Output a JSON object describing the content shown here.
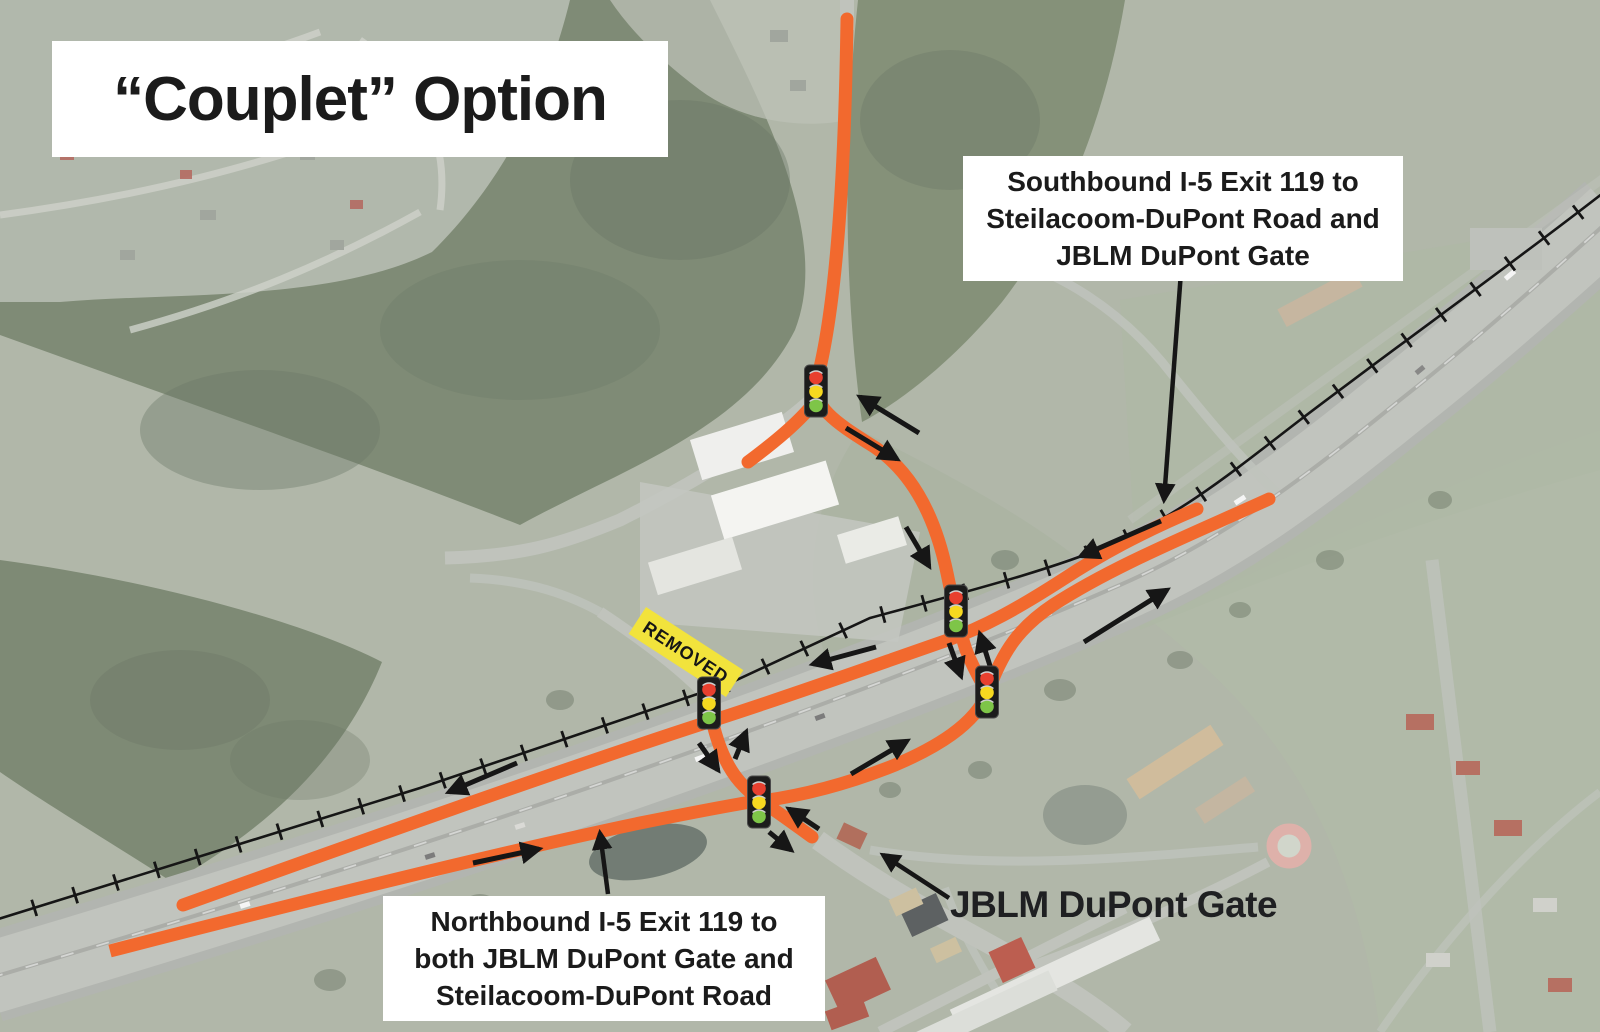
{
  "title": "“Couplet” Option",
  "callouts": {
    "southbound": {
      "lines": [
        "Southbound I-5 Exit 119 to",
        "Steilacoom-DuPont Road and",
        "JBLM DuPont Gate"
      ]
    },
    "northbound": {
      "lines": [
        "Northbound I-5 Exit 119 to",
        "both JBLM DuPont Gate and",
        "Steilacoom-DuPont Road"
      ]
    }
  },
  "map_labels": {
    "gate": "JBLM DuPont Gate",
    "removed": "REMOVED"
  },
  "colors": {
    "route_orange": "#F2692E",
    "removed_yellow": "#F2E33C",
    "signal_red": "#E8402F",
    "signal_amber": "#F7D920",
    "signal_green": "#7EC548",
    "annotation_black": "#161616"
  },
  "icons": {
    "traffic_signal_icon": "traffic-light",
    "traffic_signal_count": 5
  }
}
